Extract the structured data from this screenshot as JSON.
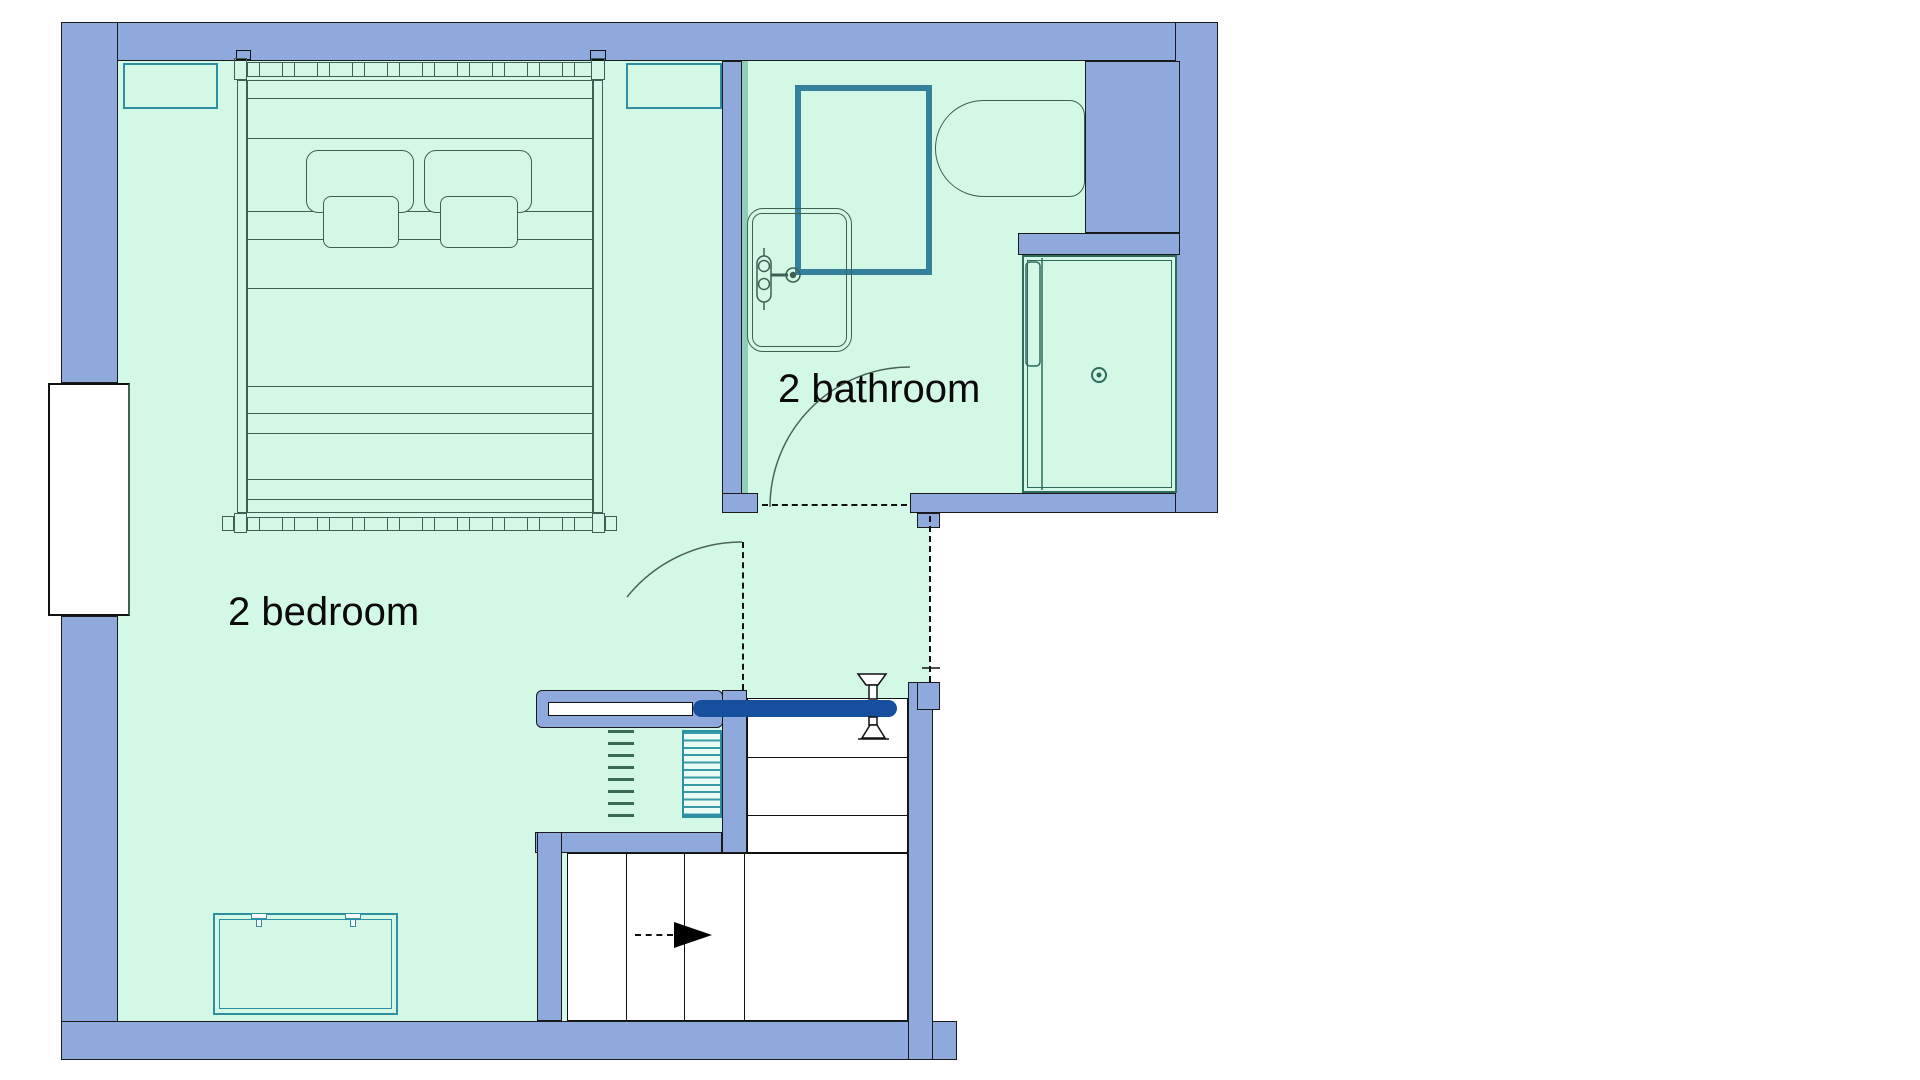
{
  "title": "apartment upper floor plan",
  "labels": {
    "bedroom": "2 bedroom",
    "bathroom": "2 bathroom"
  },
  "rooms": [
    {
      "name": "2 bedroom"
    },
    {
      "name": "2 bathroom"
    },
    {
      "name": "hall landing"
    },
    {
      "name": "shower stall"
    },
    {
      "name": "stairwell"
    }
  ],
  "fixtures": [
    "double-bed",
    "pillows",
    "dresser",
    "window",
    "bathtub",
    "tub-faucet",
    "shower-pan",
    "toilet",
    "shower-stall",
    "floor-drain",
    "stair-upper-flight",
    "stair-lower-flight",
    "direction-arrow",
    "balustrade",
    "sliding-gate",
    "loft-ladder",
    "mini-stairs",
    "bathroom-door-swing",
    "bedroom-door-swing"
  ],
  "palette": {
    "wall": "#8FA9DC",
    "wallline": "#1a1a1a",
    "mint": "#D3F9E6",
    "line": "#3E5F53",
    "teal": "#2E8FA3",
    "showerteal": "#35809C",
    "navy": "#164F9E",
    "hatch": "#3A9BA8",
    "hatchbg": "#E9FDF4",
    "stallline": "#2F6B5C",
    "ladder": "#3A6B52",
    "wallface": "#90CDBA",
    "ink": "#0a0a0a"
  }
}
